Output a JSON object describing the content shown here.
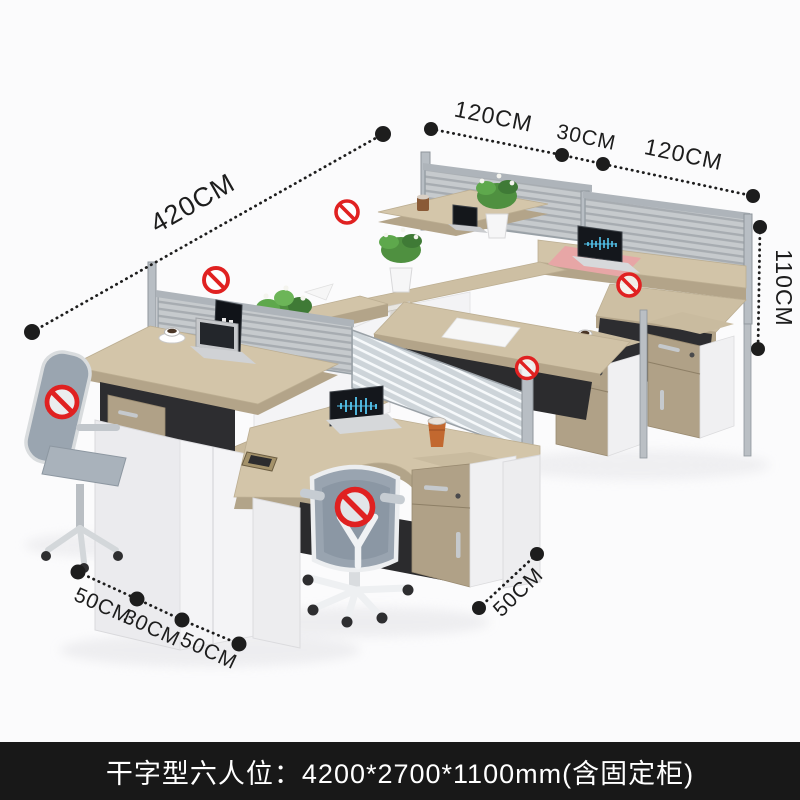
{
  "annotations": {
    "length_label": "420CM",
    "top_depth_segments": [
      "120CM",
      "30CM",
      "120CM"
    ],
    "height_label": "110CM",
    "bottom_left_segments": [
      "50CM",
      "30CM",
      "50CM"
    ],
    "bottom_right_label": "50CM"
  },
  "caption": {
    "text": "干字型六人位：4200*2700*1100mm(含固定柜)"
  },
  "icons": {
    "prohibition_sign_count": 6
  },
  "colors": {
    "background": "#fbfbfc",
    "dimension_ink": "#1d1d1d",
    "prohibition_red": "#e02121",
    "desk_wood": "#cfc1a5",
    "desk_wood_edge": "#b3a489",
    "panel_white": "#f1f1f3",
    "partition_gray": "#c6cacd",
    "chair_mesh": "#99a4b0",
    "caption_bar": "#181818",
    "caption_text": "#ffffff"
  }
}
